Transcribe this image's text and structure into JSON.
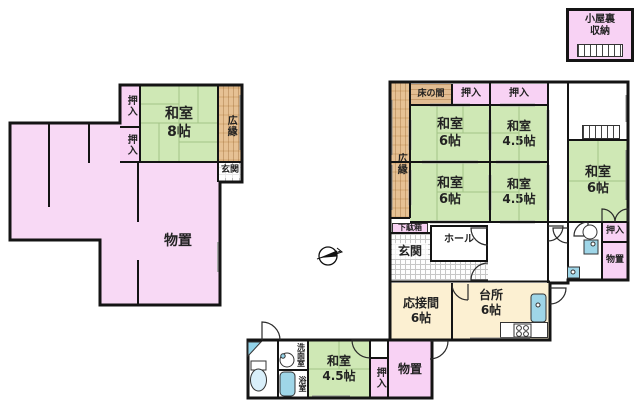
{
  "plan_title": "house-floor-plan",
  "colors": {
    "tatami_green": "#cfe8b5",
    "closet_pink": "#f8d2f4",
    "room_cream": "#fcf0d2",
    "wood_tan": "#e6c194",
    "fixture_blue": "#93d4ea",
    "wall_black": "#141414"
  },
  "attic": {
    "label": "小屋裏\n収納"
  },
  "left_building": {
    "oshiire_top": "押入",
    "oshiire_bottom": "押入",
    "washitsu8": "和室\n8帖",
    "hiroen": "広縁",
    "genkan": "玄関",
    "monooki": "物置"
  },
  "right_building": {
    "tokonoma": "床の間",
    "oshiire_a": "押入",
    "oshiire_b": "押入",
    "washitsu6_nw": "和室\n6帖",
    "washitsu45_ne": "和室\n4.5帖",
    "washitsu6_sw": "和室\n6帖",
    "washitsu45_se": "和室\n4.5帖",
    "hiroen": "広縁",
    "washitsu6_e": "和室\n6帖",
    "oshiire_e": "押入",
    "monooki_e": "物置",
    "getabako": "下駄箱",
    "genkan": "玄関",
    "hall": "ホール",
    "ousetsuma": "応接間\n6帖",
    "daidokoro": "台所\n6帖"
  },
  "annex": {
    "senmenshitsu": "洗面室",
    "yokushitsu": "浴室",
    "washitsu45": "和室\n4.5帖",
    "oshiire": "押入",
    "monooki": "物置"
  },
  "compass": {
    "direction": "north-right"
  }
}
